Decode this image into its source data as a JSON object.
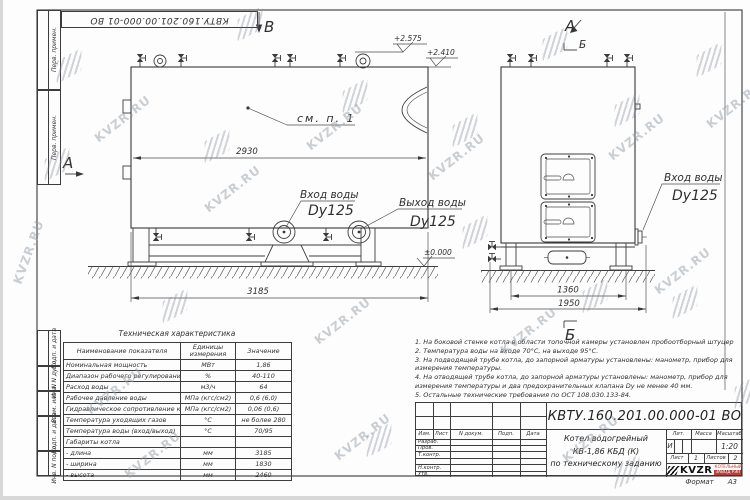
{
  "watermark": {
    "text": "KVZR.RU"
  },
  "sheet": {
    "doc_number_top": "КВТУ.160.201.00.000-01 ВО",
    "format_label": "Формат",
    "format_value": "А3"
  },
  "margin": {
    "box1": "Перв. примен.",
    "box2": "Перв. примен.",
    "box3": "Подп. и дата",
    "box4": "Инв. N дубл.",
    "box5": "Взам. инв. N",
    "box6": "Подп. и дата",
    "box7": "Инв. N подл."
  },
  "drawing": {
    "view_b": "В",
    "view_a_front": "А",
    "view_a_side": "А",
    "section_b_top": "Б",
    "section_b_bottom": "Б",
    "see_note": "см. п. 1",
    "elev_high": "+2.575",
    "elev_top": "+2.410",
    "elev_zero": "±0.000",
    "dim_front_body": "2930",
    "dim_front_overall": "3185",
    "dim_side_feet": "1360",
    "dim_side_overall": "1950",
    "inlet_front_l1": "Вход воды",
    "inlet_front_l2": "Dy125",
    "outlet_front_l1": "Выход воды",
    "outlet_front_l2": "Dy125",
    "inlet_side_l1": "Вход воды",
    "inlet_side_l2": "Dy125"
  },
  "tech_table": {
    "title": "Техническая характеристика",
    "col_name": "Наименование показателя",
    "col_units": "Единицы измерения",
    "col_value": "Значение",
    "rows": [
      {
        "name": "Номинальная мощность",
        "units": "МВт",
        "value": "1,86"
      },
      {
        "name": "Диапазон рабочего регулирования",
        "units": "%",
        "value": "40-110"
      },
      {
        "name": "Расход воды",
        "units": "м3/ч",
        "value": "64"
      },
      {
        "name": "Рабочее давление воды",
        "units": "МПа (кгс/см2)",
        "value": "0,6 (6,0)"
      },
      {
        "name": "Гидравлическое сопротивление котла",
        "units": "МПа (кгс/см2)",
        "value": "0,06 (0,6)"
      },
      {
        "name": "Температура уходящих газов",
        "units": "°С",
        "value": "не более 280"
      },
      {
        "name": "Температура воды (вход/выход)",
        "units": "°С",
        "value": "70/95"
      },
      {
        "name": "Габариты котла",
        "units": "",
        "value": ""
      },
      {
        "name": "- длина",
        "units": "мм",
        "value": "3185"
      },
      {
        "name": "- ширина",
        "units": "мм",
        "value": "1830"
      },
      {
        "name": "- высота",
        "units": "мм",
        "value": "2460"
      }
    ]
  },
  "notes": {
    "lines": [
      "1. На боковой стенке котла в области топочной камеры установлен пробоотборный штуцер",
      "2. Температура воды на входе 70°С, на выходе 95°С.",
      "3. На подводящей трубе котла, до запорной арматуры установлены: манометр, прибор для",
      "измерения температуры.",
      "4. На отводящей трубе котла, до запорной арматуры установлены: манометр, прибор для",
      "измерения температуры и два предохранительных клапана Dу не менее 40 мм.",
      "5. Остальные технические требования по ОСТ 108.030.133-84."
    ]
  },
  "title_block": {
    "doc_number": "КВТУ.160.201.00.000-01 ВО",
    "col_izm": "Изм.",
    "col_list": "Лист",
    "col_doc": "N докум.",
    "col_podp": "Подп.",
    "col_data": "Дата",
    "row_razrab": "Разраб.",
    "row_prov": "Пров.",
    "row_tkontr": "Т.контр.",
    "row_nkontr": "Н.контр.",
    "row_utv": "Утв.",
    "name_line1": "Котел водогрейный",
    "name_line2": "КВ-1,86 КБД (К)",
    "name_line3": "по техническому заданию",
    "lit_header": "Лит.",
    "mass_header": "Масса",
    "scale_header": "Масштаб",
    "lit_value": "И",
    "scale_value": "1:20",
    "sheet_label": "Лист",
    "sheet_value": "1",
    "sheets_label": "Листов",
    "sheets_value": "2",
    "logo_text": "KVZR",
    "company_line1": "КОТЕЛЬНЫЙ",
    "company_line2": "ЗАВОД РЭП"
  }
}
